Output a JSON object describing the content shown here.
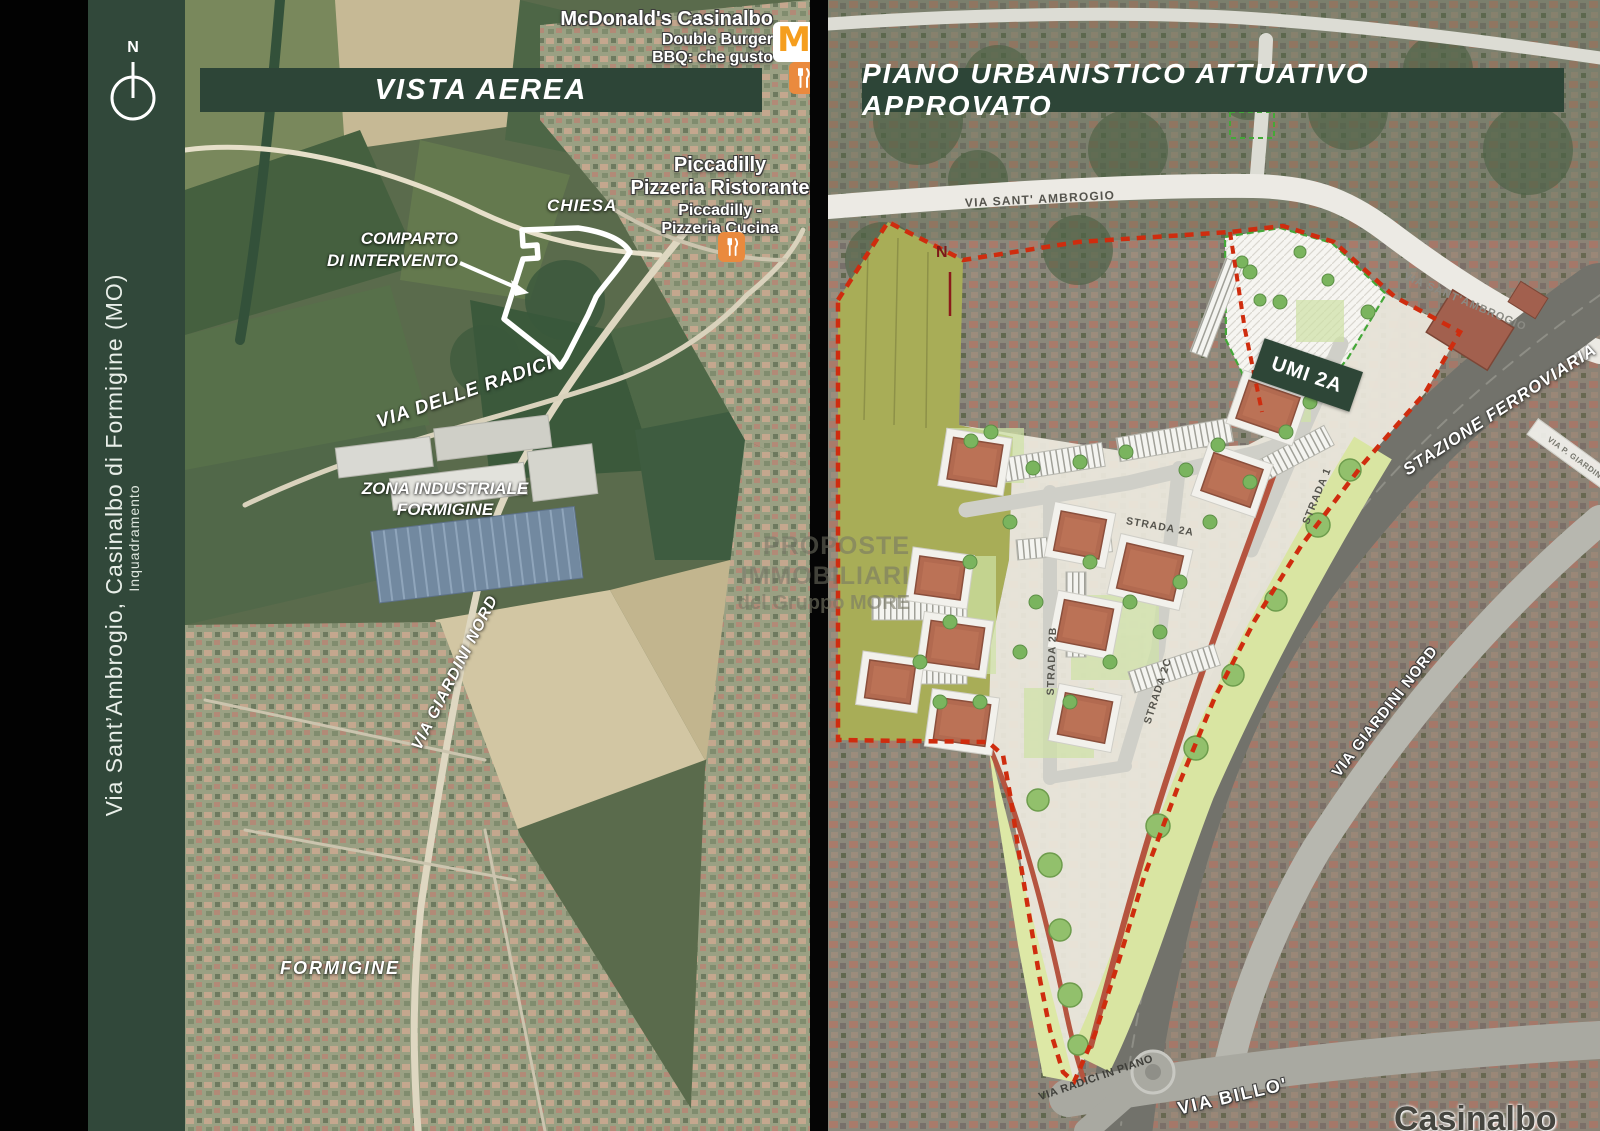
{
  "sidebar": {
    "north_label": "N",
    "title": "Via Sant’Ambrogio, Casinalbo di Formigine (MO)",
    "subtitle": "Inquadramento"
  },
  "left_map": {
    "title": "VISTA AEREA",
    "pois": {
      "mcdonalds": {
        "line1": "McDonald's Casinalbo",
        "line2": "Double Burger",
        "line3": "BBQ: che gusto"
      },
      "piccadilly": {
        "line1": "Piccadilly",
        "line2": "Pizzeria Ristorante",
        "line3": "Piccadilly -",
        "line4": "Pizzeria Cucina"
      }
    },
    "labels": {
      "chiesa": "CHIESA",
      "comparto_line1": "COMPARTO",
      "comparto_line2": "DI INTERVENTO",
      "via_delle_radici": "VIA DELLE RADICI",
      "zona_line1": "ZONA INDUSTRIALE",
      "zona_line2": "FORMIGINE",
      "via_giardini_nord": "VIA GIARDINI NORD",
      "formigine": "FORMIGINE"
    }
  },
  "right_map": {
    "title": "PIANO URBANISTICO ATTUATIVO APPROVATO",
    "north_label": "N",
    "labels": {
      "umi": "UMI 2A",
      "via_sant_ambrogio_top": "VIA SANT' AMBROGIO",
      "via_sant_ambrogio_right": "VIA SANT'AMBROGIO",
      "stazione_ferroviaria": "STAZIONE FERROVIARIA",
      "via_giardini_nord": "VIA GIARDINI NORD",
      "strada_1": "STRADA 1",
      "strada_2a": "STRADA 2A",
      "strada_2b": "STRADA 2B",
      "strada_2c": "STRADA 2C",
      "via_radici_in_piano": "VIA RADICI IN PIANO",
      "via_billo": "VIA BILLO'",
      "via_p_giardini": "VIA P. GIARDINI",
      "casinalbo_partial": "Casinalbo"
    }
  },
  "watermark": {
    "line1": "PROPOSTE IMMOBILIARI",
    "line2": "del Gruppo MORE"
  },
  "colors": {
    "panel_green": "#2d4537",
    "sidebar_green": "#31483a",
    "boundary_red": "#cf2c0e",
    "plan_cream": "#edeadf",
    "olive_field": "#a8ad57",
    "park_green": "#d9e5a2",
    "roof_brown": "#b26a50",
    "mcdonalds_orange": "#f59e1f",
    "poi_orange": "#ea8a3e"
  }
}
